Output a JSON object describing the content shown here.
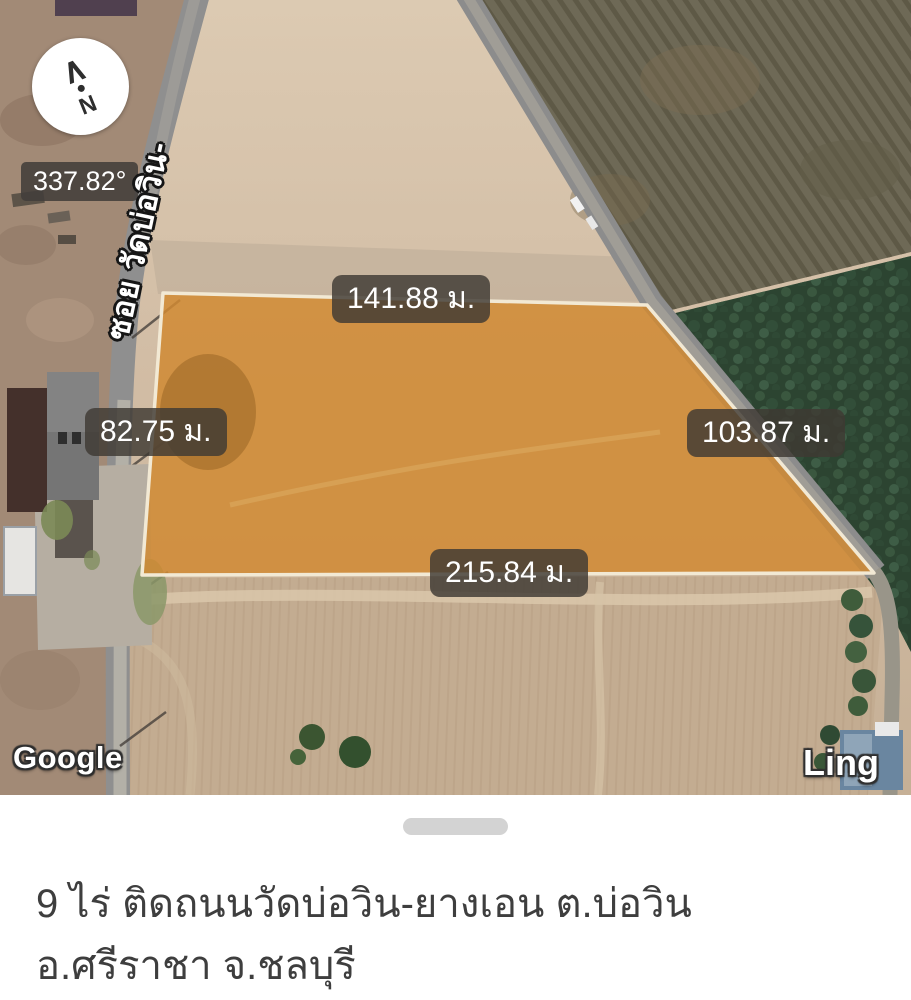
{
  "map": {
    "compass": {
      "bearing": "337.82°",
      "north": "N"
    },
    "street_label": "ซอย วัดบ่อวิน-",
    "plot": {
      "top_length": "141.88 ม.",
      "left_length": "82.75 ม.",
      "right_length": "103.87 ม.",
      "bottom_length": "215.84 ม.",
      "fill_color": "#d08a32",
      "outline_color": "#f2e9d4"
    },
    "watermark_google": "Google",
    "watermark_ling": "Ling"
  },
  "sheet": {
    "title_line1": "9 ไร่ ติดถนนวัดบ่อวิน-ยางเอน ต.บ่อวิน",
    "title_line2": "อ.ศรีราชา จ.ชลบุรี"
  }
}
